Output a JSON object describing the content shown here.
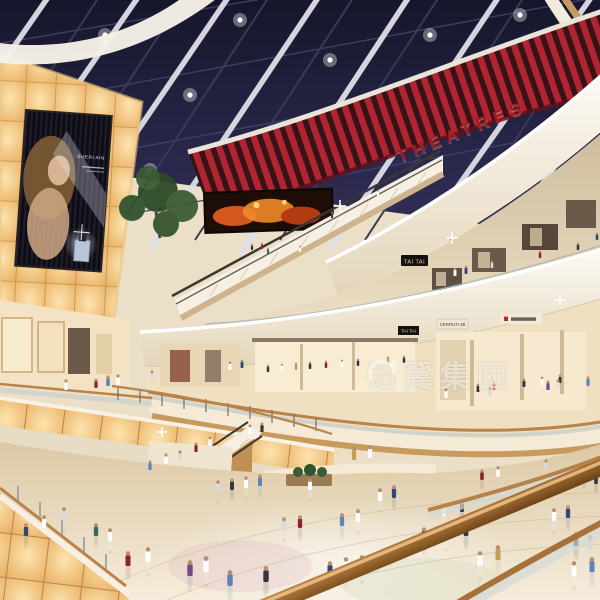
{
  "title": "Shopping mall atrium interior rendering",
  "scene": {
    "signs": {
      "theatres": {
        "text": "THEATRES",
        "color": "#9c1b24"
      },
      "billboard_brand": {
        "text": "GUERLAIN"
      },
      "tai_tai_upper": {
        "text": "TAI TAI"
      },
      "tai_tai_lower": {
        "text": "TAI TAI"
      },
      "cerruti": {
        "text": "CERRUTI 88"
      }
    },
    "watermark": {
      "text": "铝翼集团"
    },
    "palette": {
      "ceiling": "#1e1e36",
      "theatre_red": "#b02531",
      "amber_glow": "#f2c37e",
      "fascia_white": "#f6f0e4",
      "wood": "#c2925a",
      "floor": "#ead9bd",
      "handrail": "#a4703a"
    },
    "people_colors": [
      "#ffffff",
      "#2c4a78",
      "#8c2330",
      "#2f6b5c",
      "#d8d8de",
      "#5d83b8",
      "#6e4a86",
      "#c7a04e",
      "#35353f",
      "#e8e2d6",
      "#46302a",
      "#c96a4a"
    ],
    "people": [
      [
        455,
        276,
        8,
        0
      ],
      [
        466,
        274,
        8,
        1
      ],
      [
        492,
        268,
        7,
        4
      ],
      [
        540,
        258,
        7,
        2
      ],
      [
        578,
        250,
        7,
        8
      ],
      [
        300,
        252,
        6,
        0
      ],
      [
        268,
        254,
        6,
        3
      ],
      [
        597,
        240,
        7,
        1
      ],
      [
        252,
        250,
        6,
        8
      ],
      [
        262,
        249,
        6,
        2
      ],
      [
        378,
        196,
        6,
        0
      ],
      [
        332,
        218,
        6,
        8
      ],
      [
        66,
        390,
        10,
        0
      ],
      [
        96,
        388,
        9,
        2
      ],
      [
        108,
        386,
        10,
        5
      ],
      [
        118,
        385,
        10,
        0
      ],
      [
        152,
        380,
        9,
        4
      ],
      [
        230,
        370,
        8,
        0
      ],
      [
        242,
        368,
        8,
        1
      ],
      [
        268,
        372,
        7,
        8
      ],
      [
        282,
        371,
        7,
        0
      ],
      [
        296,
        370,
        7,
        7
      ],
      [
        310,
        369,
        7,
        8
      ],
      [
        326,
        368,
        7,
        2
      ],
      [
        342,
        367,
        7,
        0
      ],
      [
        358,
        366,
        7,
        8
      ],
      [
        388,
        364,
        7,
        7
      ],
      [
        404,
        363,
        7,
        8
      ],
      [
        478,
        392,
        8,
        8
      ],
      [
        494,
        390,
        8,
        11
      ],
      [
        524,
        387,
        8,
        8
      ],
      [
        542,
        385,
        8,
        0
      ],
      [
        560,
        383,
        8,
        8
      ],
      [
        446,
        398,
        9,
        0
      ],
      [
        490,
        396,
        9,
        4
      ],
      [
        548,
        390,
        9,
        6
      ],
      [
        558,
        389,
        9,
        9
      ],
      [
        588,
        386,
        9,
        5
      ],
      [
        354,
        460,
        12,
        7
      ],
      [
        370,
        458,
        12,
        0
      ],
      [
        166,
        464,
        10,
        0
      ],
      [
        180,
        461,
        10,
        4
      ],
      [
        150,
        470,
        9,
        5
      ],
      [
        250,
        434,
        9,
        0
      ],
      [
        262,
        432,
        9,
        8
      ],
      [
        196,
        452,
        9,
        2
      ],
      [
        210,
        446,
        9,
        0
      ],
      [
        482,
        480,
        10,
        2
      ],
      [
        498,
        477,
        10,
        0
      ],
      [
        546,
        470,
        10,
        4
      ],
      [
        584,
        480,
        10,
        5
      ],
      [
        596,
        484,
        10,
        8
      ],
      [
        444,
        516,
        11,
        0
      ],
      [
        462,
        512,
        11,
        8
      ],
      [
        26,
        536,
        12,
        1
      ],
      [
        44,
        528,
        12,
        0
      ],
      [
        64,
        520,
        12,
        4
      ],
      [
        96,
        536,
        12,
        3
      ],
      [
        110,
        541,
        12,
        0
      ],
      [
        128,
        566,
        14,
        2
      ],
      [
        148,
        562,
        14,
        0
      ],
      [
        190,
        576,
        15,
        6
      ],
      [
        206,
        572,
        15,
        0
      ],
      [
        230,
        586,
        15,
        5
      ],
      [
        266,
        582,
        15,
        8
      ],
      [
        284,
        530,
        12,
        4
      ],
      [
        300,
        528,
        12,
        2
      ],
      [
        342,
        526,
        12,
        5
      ],
      [
        358,
        522,
        12,
        0
      ],
      [
        330,
        576,
        14,
        1
      ],
      [
        346,
        572,
        14,
        0
      ],
      [
        362,
        570,
        14,
        4
      ],
      [
        380,
        501,
        12,
        0
      ],
      [
        394,
        498,
        12,
        1
      ],
      [
        310,
        490,
        11,
        0
      ],
      [
        218,
        492,
        11,
        4
      ],
      [
        232,
        490,
        11,
        8
      ],
      [
        246,
        488,
        11,
        0
      ],
      [
        260,
        486,
        11,
        5
      ],
      [
        424,
        541,
        13,
        1
      ],
      [
        446,
        538,
        13,
        0
      ],
      [
        466,
        536,
        13,
        8
      ],
      [
        480,
        566,
        14,
        0
      ],
      [
        498,
        560,
        14,
        7
      ],
      [
        554,
        521,
        12,
        0
      ],
      [
        568,
        518,
        12,
        1
      ],
      [
        576,
        546,
        13,
        8
      ],
      [
        590,
        549,
        13,
        4
      ],
      [
        592,
        572,
        14,
        5
      ],
      [
        574,
        576,
        14,
        0
      ]
    ]
  }
}
